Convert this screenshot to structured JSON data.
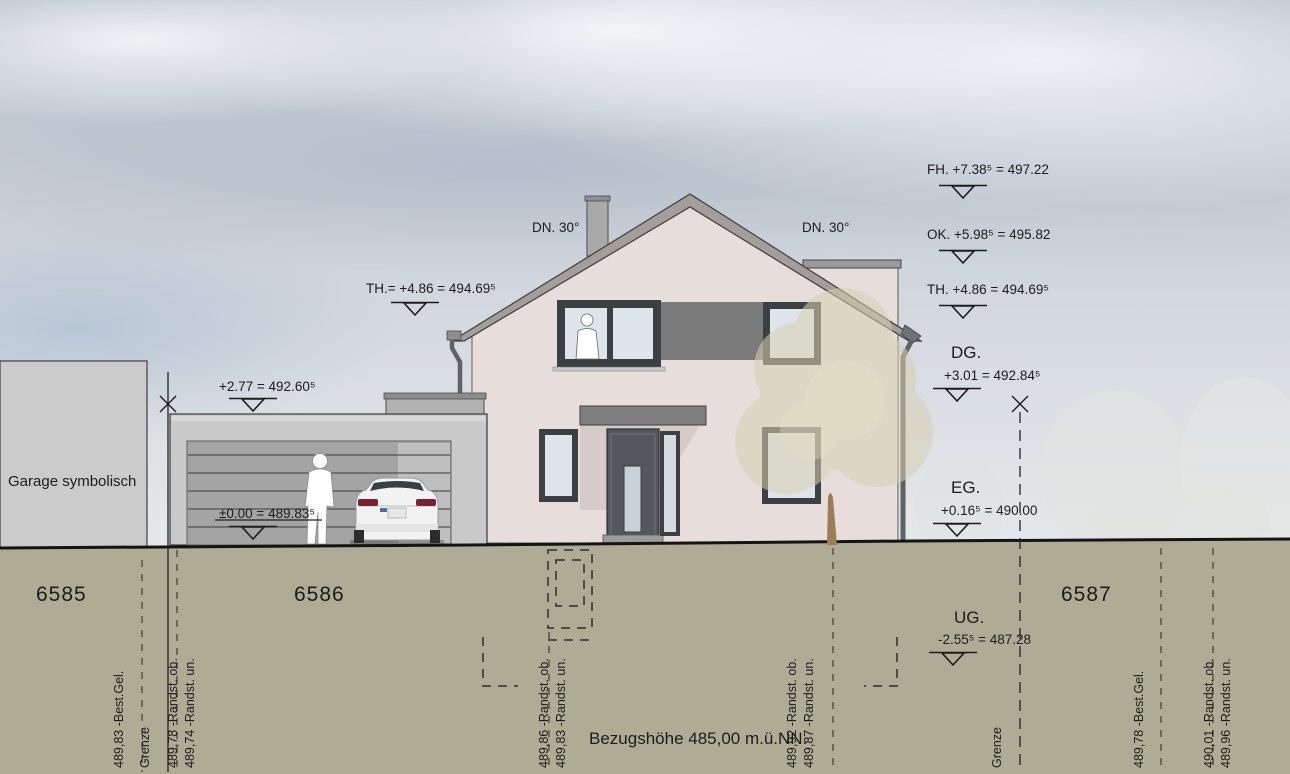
{
  "colors": {
    "wall": "#e7dedb",
    "band": "#7b7b7b",
    "roof": "#a49e9a",
    "frame": "#3d4042",
    "glass": "#dde5ea",
    "canopy": "#7e7e7e",
    "garage": "#c9c9c9",
    "garage-door": "#a4a4a4",
    "neighbor": "#cbcbcb",
    "earth": "#aeac95",
    "tree": "#d8d0b2",
    "ink": "#1c1c1c"
  },
  "scene": {
    "neighbor_garage_label": "Garage symbolisch",
    "reference_note": "Bezugshöhe  485,00 m.ü.NN."
  },
  "parcels": {
    "p6585": "6585",
    "p6586": "6586",
    "p6587": "6587"
  },
  "roof": {
    "pitch_left": "DN. 30°",
    "pitch_right": "DN. 30°"
  },
  "levels": {
    "fh": "FH. +7.38⁵ = 497.22",
    "ok": "OK. +5.98⁵ = 495.82",
    "th_right": "TH. +4.86  = 494.69⁵",
    "th_left": "TH.= +4.86  = 494.69⁵",
    "dg_label": "DG.",
    "dg_value": "+3.01  = 492.84⁵",
    "eg_label": "EG.",
    "eg_value": "+0.16⁵ = 490.00",
    "ug_label": "UG.",
    "ug_value": "-2.55⁵ = 487.28",
    "garage_roof": "+2.77  = 492.60⁵",
    "garage_floor": "±0.00  = 489.83⁵"
  },
  "boundaries": {
    "left": "Grenze",
    "right": "Grenze"
  },
  "survey": {
    "left_best_gel": "489,83  -Best.Gel.",
    "left_randst_ob": "489,78  -Randst. ob.",
    "left_randst_un": "489,74  -Randst. un.",
    "mid_left_randst_ob": "489,86  -Randst. ob.",
    "mid_left_randst_un": "489,83  -Randst. un.",
    "mid_right_randst_ob": "489,92  -Randst. ob.",
    "mid_right_randst_un": "489,87  -Randst. un.",
    "right_best_gel": "489,78  -Best.Gel.",
    "right_randst_ob": "490,01  -Randst. ob.",
    "right_randst_un": "489,96  -Randst. un."
  }
}
